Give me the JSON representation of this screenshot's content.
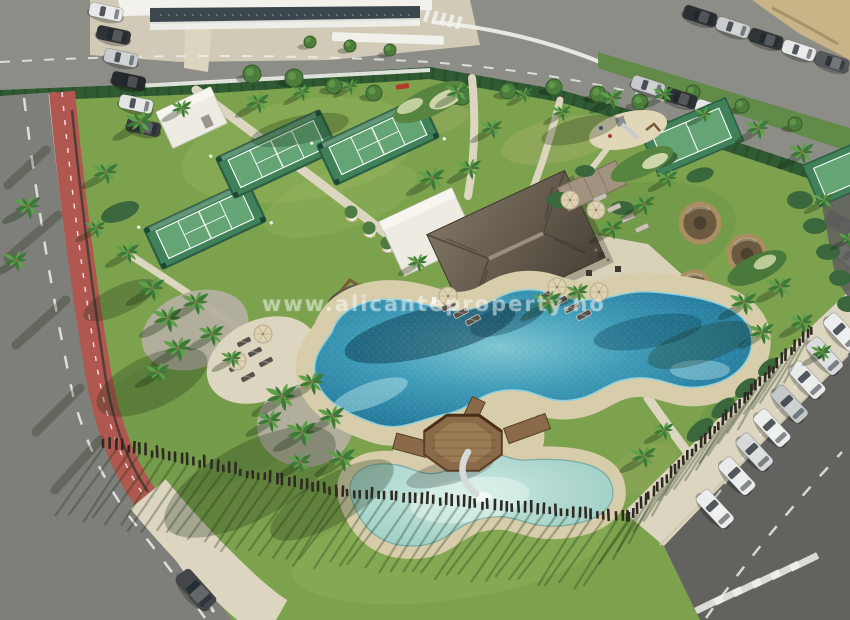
{
  "meta": {
    "title": "Aerial drone photograph of a resort amenity area with lagoon swimming pools, a thatched-roof pool bar, padel courts, palm gardens, a red bike lane and parking lots"
  },
  "watermark": {
    "text": "www.alicanteproperty.no"
  },
  "palette": {
    "grass": "#7da24e",
    "grass2": "#97b95f",
    "grass3": "#5f8c3e",
    "pave": "#8d8d88",
    "walk": "#dcd5bf",
    "sand": "#d7cdaa",
    "sandlot": "#c9b488",
    "road": "#7e7e7a",
    "asphalt": "#62625f",
    "track": "#b0574f",
    "white": "#f2f1ec",
    "pool1": "#7fc6d2",
    "pool2": "#3f9cb8",
    "pool3": "#1f7396",
    "kids1": "#cde8e0",
    "kids2": "#96cbc2",
    "wood": "#8a6a48",
    "wood2": "#66492f",
    "wood3": "#9c7c55",
    "thatcha": "#7d7262",
    "thatchb": "#4a4238",
    "bldg": "#edebe2",
    "stone": "#a29381",
    "court1": "#41815a",
    "court2": "#64a475",
    "courtfence": "#2c5d45",
    "hedge": "#305a33",
    "shrub": "#3a683c",
    "gravel": "#b4afa0",
    "palm1": "#3e7a37",
    "palm2": "#5fa04a",
    "trunk": "#8a6f4e",
    "fence": "#2e2922",
    "cabana": "#a98e62",
    "umbrella": "#ddd2b2",
    "lounger": "#57524a",
    "slide": "#d6dadb",
    "wm": "rgba(255,255,255,0.42)"
  }
}
